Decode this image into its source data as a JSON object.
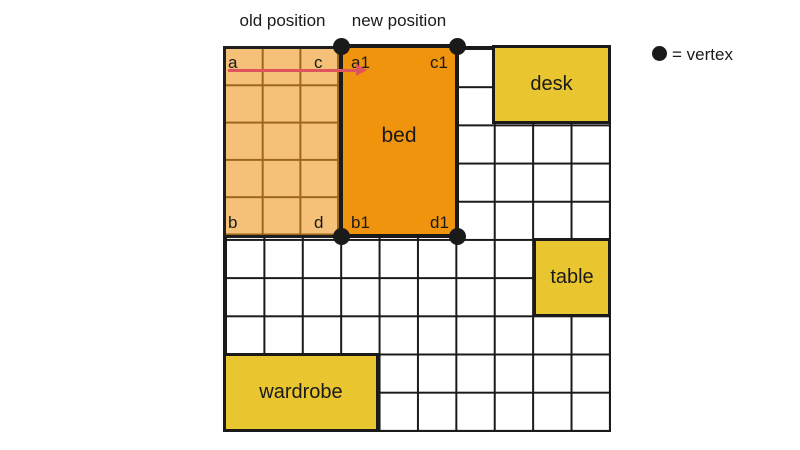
{
  "labels": {
    "old_position": "old position",
    "new_position": "new position"
  },
  "legend": {
    "symbol": "vertex-dot",
    "text": "= vertex"
  },
  "grid": {
    "columns": 10,
    "rows": 10
  },
  "old_position": {
    "corners": {
      "top_left": "a",
      "top_right": "c",
      "bottom_left": "b",
      "bottom_right": "d"
    }
  },
  "new_position": {
    "label": "bed",
    "corners": {
      "top_left": "a1",
      "top_right": "c1",
      "bottom_left": "b1",
      "bottom_right": "d1"
    }
  },
  "furniture": {
    "desk": "desk",
    "table": "table",
    "wardrobe": "wardrobe"
  },
  "colors": {
    "background": "#ffffff",
    "grid_line": "#1a1a1a",
    "old_fill": "#f5c077",
    "old_grid_line": "#9c671d",
    "bed_fill": "#f0930d",
    "furniture_fill": "#e9c52f",
    "arrow": "#e0545e",
    "vertex_dot": "#1a1a1a",
    "text": "#1a1a1a"
  }
}
